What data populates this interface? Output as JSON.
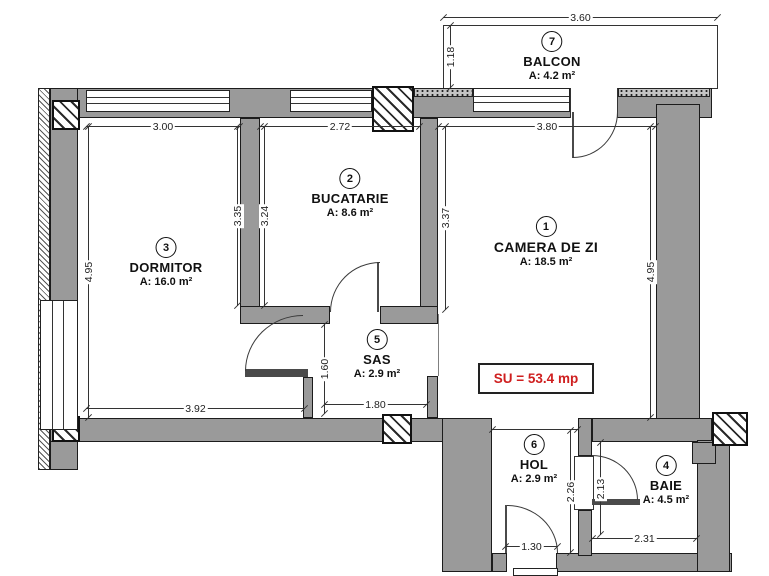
{
  "su_total": "SU = 53.4 mp",
  "rooms": [
    {
      "num": "1",
      "name": "CAMERA DE ZI",
      "area": "A: 18.5 m²"
    },
    {
      "num": "2",
      "name": "BUCATARIE",
      "area": "A: 8.6 m²"
    },
    {
      "num": "3",
      "name": "DORMITOR",
      "area": "A: 16.0 m²"
    },
    {
      "num": "4",
      "name": "BAIE",
      "area": "A: 4.5 m²"
    },
    {
      "num": "5",
      "name": "SAS",
      "area": "A: 2.9 m²"
    },
    {
      "num": "6",
      "name": "HOL",
      "area": "A: 2.9 m²"
    },
    {
      "num": "7",
      "name": "BALCON",
      "area": "A: 4.2 m²"
    }
  ],
  "dims": {
    "balcony_w": "3.60",
    "balcony_d": "1.18",
    "dorm_w": "3.00",
    "kitchen_w": "2.72",
    "living_w": "3.80",
    "dorm_h": "4.95",
    "living_h": "4.95",
    "dorm_wall_h": "3.35",
    "kitchen_wall_l": "3.24",
    "kitchen_wall_r": "3.37",
    "dorm_bottom_w": "3.92",
    "sas_w": "1.80",
    "sas_h": "1.60",
    "hol_door_w": "1.30",
    "hol_h": "2.26",
    "baie_door_h": "2.13",
    "baie_w": "2.31"
  },
  "colors": {
    "wall": "#9a9a9a",
    "outline": "#1c1c1c",
    "accent_red": "#cf1f1f"
  }
}
